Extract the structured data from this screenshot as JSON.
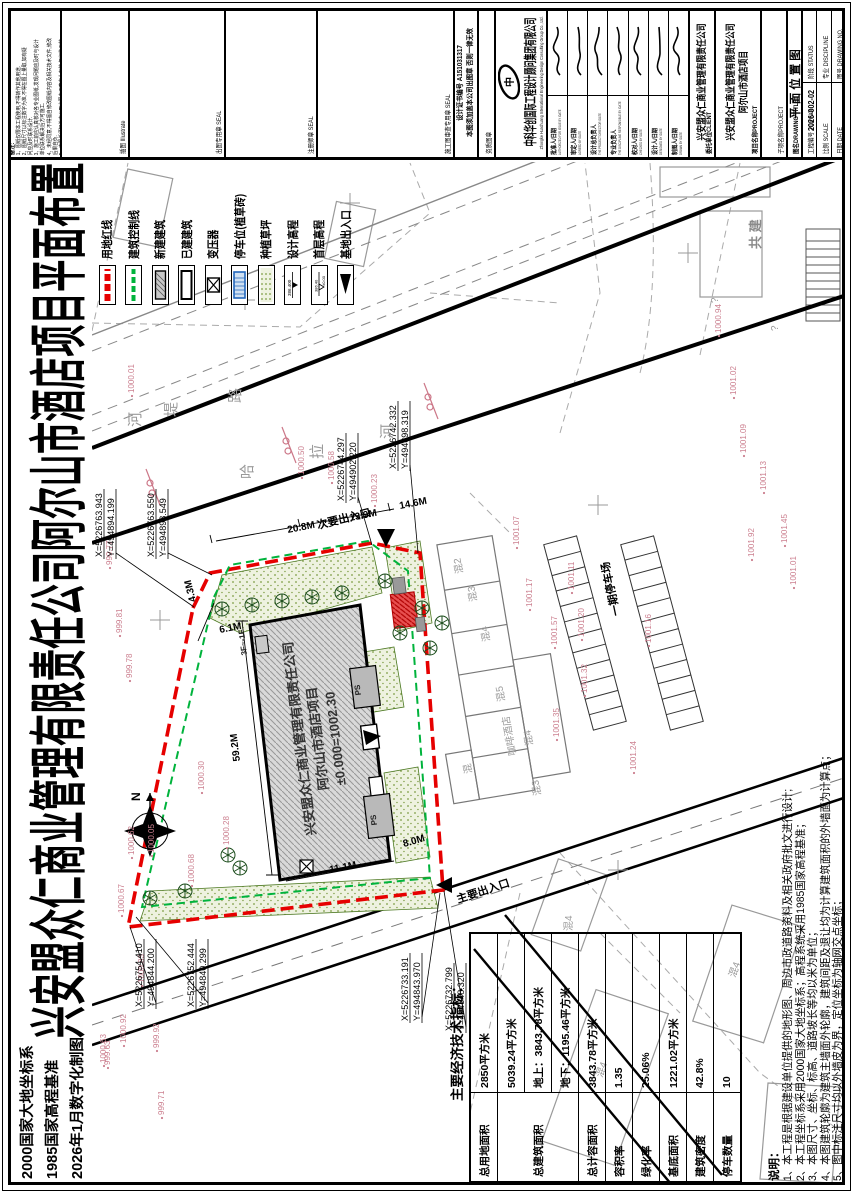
{
  "page": {
    "big_title": "兴安盟众仁商业管理有限责任公司阿尔山市酒店项目平面布置图",
    "corner_lines": [
      "2000国家大地坐标系",
      "1985国家高程基准",
      "2026年1月数字化制图"
    ]
  },
  "remark_cell": {
    "title": "备注:",
    "lines": [
      "1、图纸仅限本工程使用,不得转作其他用途.",
      "2、图纸尺寸以标注数字为准,不得在图上量取,如有疑",
      "问应及时联系设计.",
      "3、施工前应认真核对各专业图纸,发现问题应及时与设计",
      "单位联系解决后方可施工.",
      "4、未经同意,不得擅自修改图纸内容及相关技术文件,修改",
      "后果自负.",
      "5、本图纸须加盖本公司出图专用章方为有效,复印件无效,",
      "盗版必究,违者追究法律责任."
    ]
  },
  "titleblock": {
    "illustrate_label": "插图 Illustrate",
    "seal1_label": "出图专用章 SEAL",
    "seal2_label": "注册师章 SEAL",
    "seal3_label": "施工图审查专用章 SEAL",
    "cert_no": "设计证书编号  A151031317",
    "cert_note": "本图须加盖本公司出图章 否则一律无效",
    "qual_label": "资质图章",
    "logo_text": "中科华创",
    "company": "中科华创国际工程设计顾问集团有限公司",
    "company_en": "Zhongke Huachuang International Engineering Design Consulting Group Co., Ltd.",
    "personnel": [
      {
        "role": "批准人/日期",
        "en": "AUTHORIZED FOR ISSUE BY /DATE"
      },
      {
        "role": "审定人/日期",
        "en": "AGREED BY /DATE"
      },
      {
        "role": "设计总负责人",
        "en": "THE PROJECT DIRECTOR /DATE"
      },
      {
        "role": "专业负责人",
        "en": "THE DISCIPLINE RESPONSIBLE BY /DATE"
      },
      {
        "role": "校对人/日期",
        "en": "CHECKED BY /DATE"
      },
      {
        "role": "设计人/日期",
        "en": "DESIGNED BY /DATE"
      },
      {
        "role": "制图人/日期",
        "en": "DRAWN BY /DATE"
      }
    ],
    "client_label": "委托单位CLIENT",
    "client": "兴安盟众仁商业管理有限责任公司",
    "project_label": "项目名称PROJECT",
    "project_line1": "兴安盟众仁商业管理有限责任公司",
    "project_line2": "阿尔山市酒店项目",
    "subproject_label": "子项名称PROJECT",
    "drawing_title_label": "图名DRAWING TITLE",
    "drawing_title": "平面位置图",
    "job_no_label": "工程编号 JOB NO.",
    "job_no": "2026-002-02",
    "scale_label": "比例 SCALE",
    "date_label": "日期 DATE",
    "status_label": "阶段 STATUS",
    "discipline_label": "专业 DISCIPLINE",
    "dwg_no_label": "图号 DRAWING NO."
  },
  "legend": {
    "items": [
      {
        "label": "用地红线",
        "type": "redline"
      },
      {
        "label": "建筑控制线",
        "type": "greenline"
      },
      {
        "label": "新建建筑",
        "type": "newbld"
      },
      {
        "label": "已建建筑",
        "type": "oldbld"
      },
      {
        "label": "变压器",
        "type": "transformer"
      },
      {
        "label": "停车位(植草砖)",
        "type": "parking"
      },
      {
        "label": "种植草坪",
        "type": "grass"
      },
      {
        "label": "设计高程",
        "type": "design-elev",
        "sample": "386.400"
      },
      {
        "label": "首层高程",
        "type": "floor-elev",
        "sample": "386.40"
      },
      {
        "label": "基地出入口",
        "type": "entrance"
      }
    ]
  },
  "econ_table": {
    "title": "主要经济技术指标：",
    "rows": [
      {
        "label": "总用地面积",
        "cells": [
          "2850平方米"
        ]
      },
      {
        "label": "总建筑面积",
        "cells": [
          "5039.24平方米",
          "地上：3843.78平方米",
          "地下：1195.46平方米"
        ]
      },
      {
        "label": "总计容面积",
        "cells": [
          "3843.78平方米"
        ]
      },
      {
        "label": "容积率",
        "cells": [
          "1.35"
        ]
      },
      {
        "label": "绿化率",
        "cells": [
          "25.06%"
        ]
      },
      {
        "label": "基底面积",
        "cells": [
          "1221.02平方米"
        ]
      },
      {
        "label": "建筑密度",
        "cells": [
          "42.8%"
        ]
      },
      {
        "label": "停车数量",
        "cells": [
          "10"
        ]
      }
    ]
  },
  "notes": {
    "title": "说明：",
    "lines": [
      "1、本工程是根据建设单位提供的地形图、周边市政道路资料及相关政府批文进行设计;",
      "2、本工程坐标系采用2000国家大地坐标系；高程系统采用1985国家高程基准；",
      "3、本图尺寸、坐标、标高、道路坡长等均以米为单位；",
      "4、本图建筑轮廓为建筑主墙面外轮廓，建筑间距及退让均为计算建筑面积的外墙面为计算点；",
      "5、图中标注尺寸均以外墙皮为界，定位坐标为轴网交点坐标；"
    ]
  },
  "plan": {
    "building": {
      "name_line1": "兴安盟众仁商业管理有限责任公司",
      "name_line2": "阿尔山市酒店项目",
      "elevation": "±0.000=1002.30",
      "floors": "3F~-1F"
    },
    "north_label": "N",
    "coordinates": [
      {
        "l1": "X=5226763.943",
        "l2": "Y=494894.199",
        "x": 636,
        "y": 102,
        "tx": 586,
        "ty": 194
      },
      {
        "l1": "X=5226763.550",
        "l2": "Y=494898.549",
        "x": 636,
        "y": 154,
        "tx": 618,
        "ty": 212
      },
      {
        "l1": "X=5226744.297",
        "l2": "Y=494902.220",
        "x": 692,
        "y": 344,
        "tx": 648,
        "ty": 372
      },
      {
        "l1": "X=5226742.332",
        "l2": "Y=494898.319",
        "x": 724,
        "y": 396,
        "tx": 640,
        "ty": 418
      },
      {
        "l1": "X=5226754.410",
        "l2": "Y=494844.200",
        "x": 186,
        "y": 142,
        "tx": 266,
        "ty": 130
      },
      {
        "l1": "X=5226752.444",
        "l2": "Y=494840.299",
        "x": 186,
        "y": 194,
        "tx": 276,
        "ty": 136
      },
      {
        "l1": "X=5226733.191",
        "l2": "Y=494843.970",
        "x": 172,
        "y": 408,
        "tx": 300,
        "ty": 440
      },
      {
        "l1": "X=5226732.799",
        "l2": "Y=494848.320",
        "x": 162,
        "y": 452,
        "tx": 302,
        "ty": 444
      }
    ],
    "dimensions": [
      {
        "t": "20.8M",
        "x": 660,
        "y": 288,
        "r": 79
      },
      {
        "t": "13.9M",
        "x": 672,
        "y": 350,
        "r": 79
      },
      {
        "t": "14.6M",
        "x": 684,
        "y": 400,
        "r": 79
      },
      {
        "t": "4.3M",
        "x": 592,
        "y": 196,
        "r": -14
      },
      {
        "t": "6.1M",
        "x": 560,
        "y": 220,
        "r": 79
      },
      {
        "t": "59.2M",
        "x": 432,
        "y": 240,
        "r": -7
      },
      {
        "t": "11.1M",
        "x": 320,
        "y": 330,
        "r": 79
      },
      {
        "t": "8.0M",
        "x": 346,
        "y": 404,
        "r": 74
      }
    ],
    "labels": [
      {
        "t": "河",
        "x": 766,
        "y": 140,
        "r": 0,
        "c": "st"
      },
      {
        "t": "堤",
        "x": 776,
        "y": 176,
        "r": 0,
        "c": "st"
      },
      {
        "t": "路",
        "x": 790,
        "y": 240,
        "r": 0,
        "c": "st"
      },
      {
        "t": "哈",
        "x": 714,
        "y": 252,
        "r": 0,
        "c": "st"
      },
      {
        "t": "拉",
        "x": 734,
        "y": 322,
        "r": 0,
        "c": "st"
      },
      {
        "t": "河",
        "x": 754,
        "y": 392,
        "r": 0,
        "c": "st"
      },
      {
        "t": "次要出入口",
        "x": 664,
        "y": 318,
        "r": 76,
        "c": "bk"
      },
      {
        "t": "主要出入口",
        "x": 290,
        "y": 458,
        "r": 72,
        "c": "bk"
      },
      {
        "t": "一期停车场",
        "x": 578,
        "y": 620,
        "r": -12,
        "c": "bk"
      },
      {
        "t": "混2",
        "x": 620,
        "y": 463,
        "r": -10,
        "c": "gy"
      },
      {
        "t": "混3",
        "x": 592,
        "y": 477,
        "r": -10,
        "c": "gy"
      },
      {
        "t": "混4",
        "x": 552,
        "y": 490,
        "r": -10,
        "c": "gy"
      },
      {
        "t": "混5",
        "x": 492,
        "y": 505,
        "r": -10,
        "c": "gy"
      },
      {
        "t": "咖啡酒店",
        "x": 438,
        "y": 516,
        "r": -10,
        "c": "gy"
      },
      {
        "t": "混4",
        "x": 448,
        "y": 533,
        "r": -10,
        "c": "gy"
      },
      {
        "t": "混3",
        "x": 398,
        "y": 541,
        "r": -10,
        "c": "gy"
      },
      {
        "t": "混",
        "x": 420,
        "y": 472,
        "r": -10,
        "c": "gy"
      },
      {
        "t": "混4",
        "x": 115,
        "y": 602,
        "r": 20,
        "c": "gy"
      },
      {
        "t": "混4",
        "x": 215,
        "y": 735,
        "r": 20,
        "c": "gy"
      },
      {
        "t": "混4",
        "x": 262,
        "y": 572,
        "r": 0,
        "c": "gy"
      },
      {
        "t": "共  建",
        "x": 944,
        "y": 760,
        "r": 0,
        "c": "gy2"
      },
      {
        "t": "?",
        "x": 890,
        "y": 718,
        "r": 0,
        "c": "gy"
      },
      {
        "t": "?",
        "x": 862,
        "y": 778,
        "r": 0,
        "c": "gy"
      },
      {
        "t": "PS",
        "x": 498,
        "y": 361,
        "r": -7,
        "c": "ps"
      },
      {
        "t": "PS",
        "x": 368,
        "y": 377,
        "r": -7,
        "c": "ps"
      },
      {
        "t": "3F~-1F",
        "x": 538,
        "y": 247,
        "r": -7,
        "c": "ps"
      }
    ],
    "elevations": [
      [
        "999.63",
        128,
        106
      ],
      [
        "999.71",
        78,
        160
      ],
      [
        "999.77",
        628,
        108
      ],
      [
        "999.78",
        515,
        128
      ],
      [
        "999.81",
        560,
        118
      ],
      [
        "999.92",
        145,
        155
      ],
      [
        "1000.01",
        800,
        130
      ],
      [
        "1000.05",
        340,
        150
      ],
      [
        "1000.23",
        690,
        373
      ],
      [
        "1000.28",
        348,
        225
      ],
      [
        "1000.30",
        403,
        200
      ],
      [
        "1000.50",
        718,
        300
      ],
      [
        "1000.58",
        713,
        330
      ],
      [
        "1000.62",
        338,
        130
      ],
      [
        "1000.63",
        130,
        102
      ],
      [
        "1000.67",
        280,
        120
      ],
      [
        "1000.68",
        310,
        190
      ],
      [
        "1000.83",
        210,
        140
      ],
      [
        "1000.92",
        150,
        122
      ],
      [
        "1000.94",
        860,
        717
      ],
      [
        "1001.02",
        798,
        732
      ],
      [
        "1001.07",
        648,
        515
      ],
      [
        "1001.09",
        740,
        742
      ],
      [
        "1001.11",
        603,
        570
      ],
      [
        "1001.13",
        703,
        762
      ],
      [
        "1001.16",
        550,
        647
      ],
      [
        "1001.17",
        586,
        528
      ],
      [
        "1001.20",
        556,
        580
      ],
      [
        "1001.24",
        423,
        632
      ],
      [
        "1001.32",
        500,
        583
      ],
      [
        "1001.35",
        456,
        555
      ],
      [
        "1001.45",
        650,
        783
      ],
      [
        "1001.57",
        548,
        553
      ],
      [
        "1001.92",
        636,
        750
      ],
      [
        "1001.01",
        608,
        792
      ]
    ]
  },
  "colors": {
    "red_line": "#e60000",
    "green_line": "#00b33c",
    "pink": "#cc8090",
    "grey": "#9a9a9a",
    "building_fill": "#d9d9d9"
  }
}
